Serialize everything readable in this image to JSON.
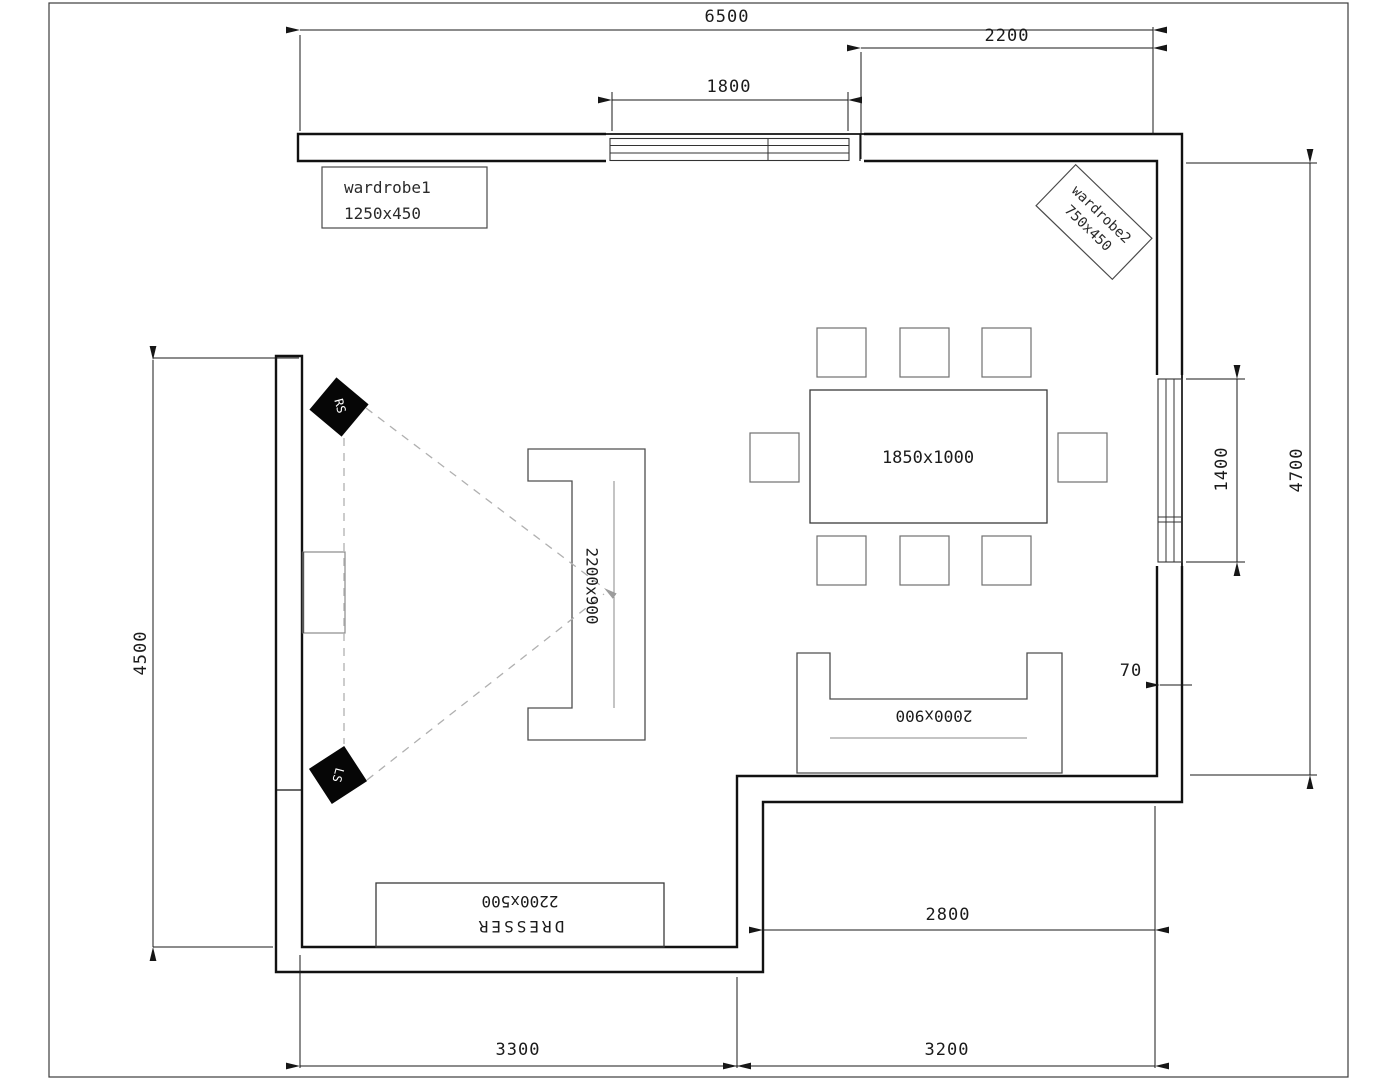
{
  "dimensions": {
    "top_overall": "6500",
    "top_right": "2200",
    "window_top": "1800",
    "window_right": "1400",
    "right_overall": "4700",
    "offset_70": "70",
    "left_overall": "4500",
    "bottom_left": "3300",
    "bottom_right": "3200",
    "alcove": "2800"
  },
  "furniture": {
    "wardrobe1": {
      "label": "wardrobe1",
      "size": "1250x450"
    },
    "wardrobe2": {
      "label": "wardrobe2",
      "size": "750x450"
    },
    "table": {
      "size": "1850x1000"
    },
    "sofa_left": {
      "size": "2200x900"
    },
    "sofa_bottom": {
      "size": "2000x900"
    },
    "dresser": {
      "label": "DRESSER",
      "size": "2200x500"
    },
    "speaker_rs": "RS",
    "speaker_ls": "LS"
  }
}
